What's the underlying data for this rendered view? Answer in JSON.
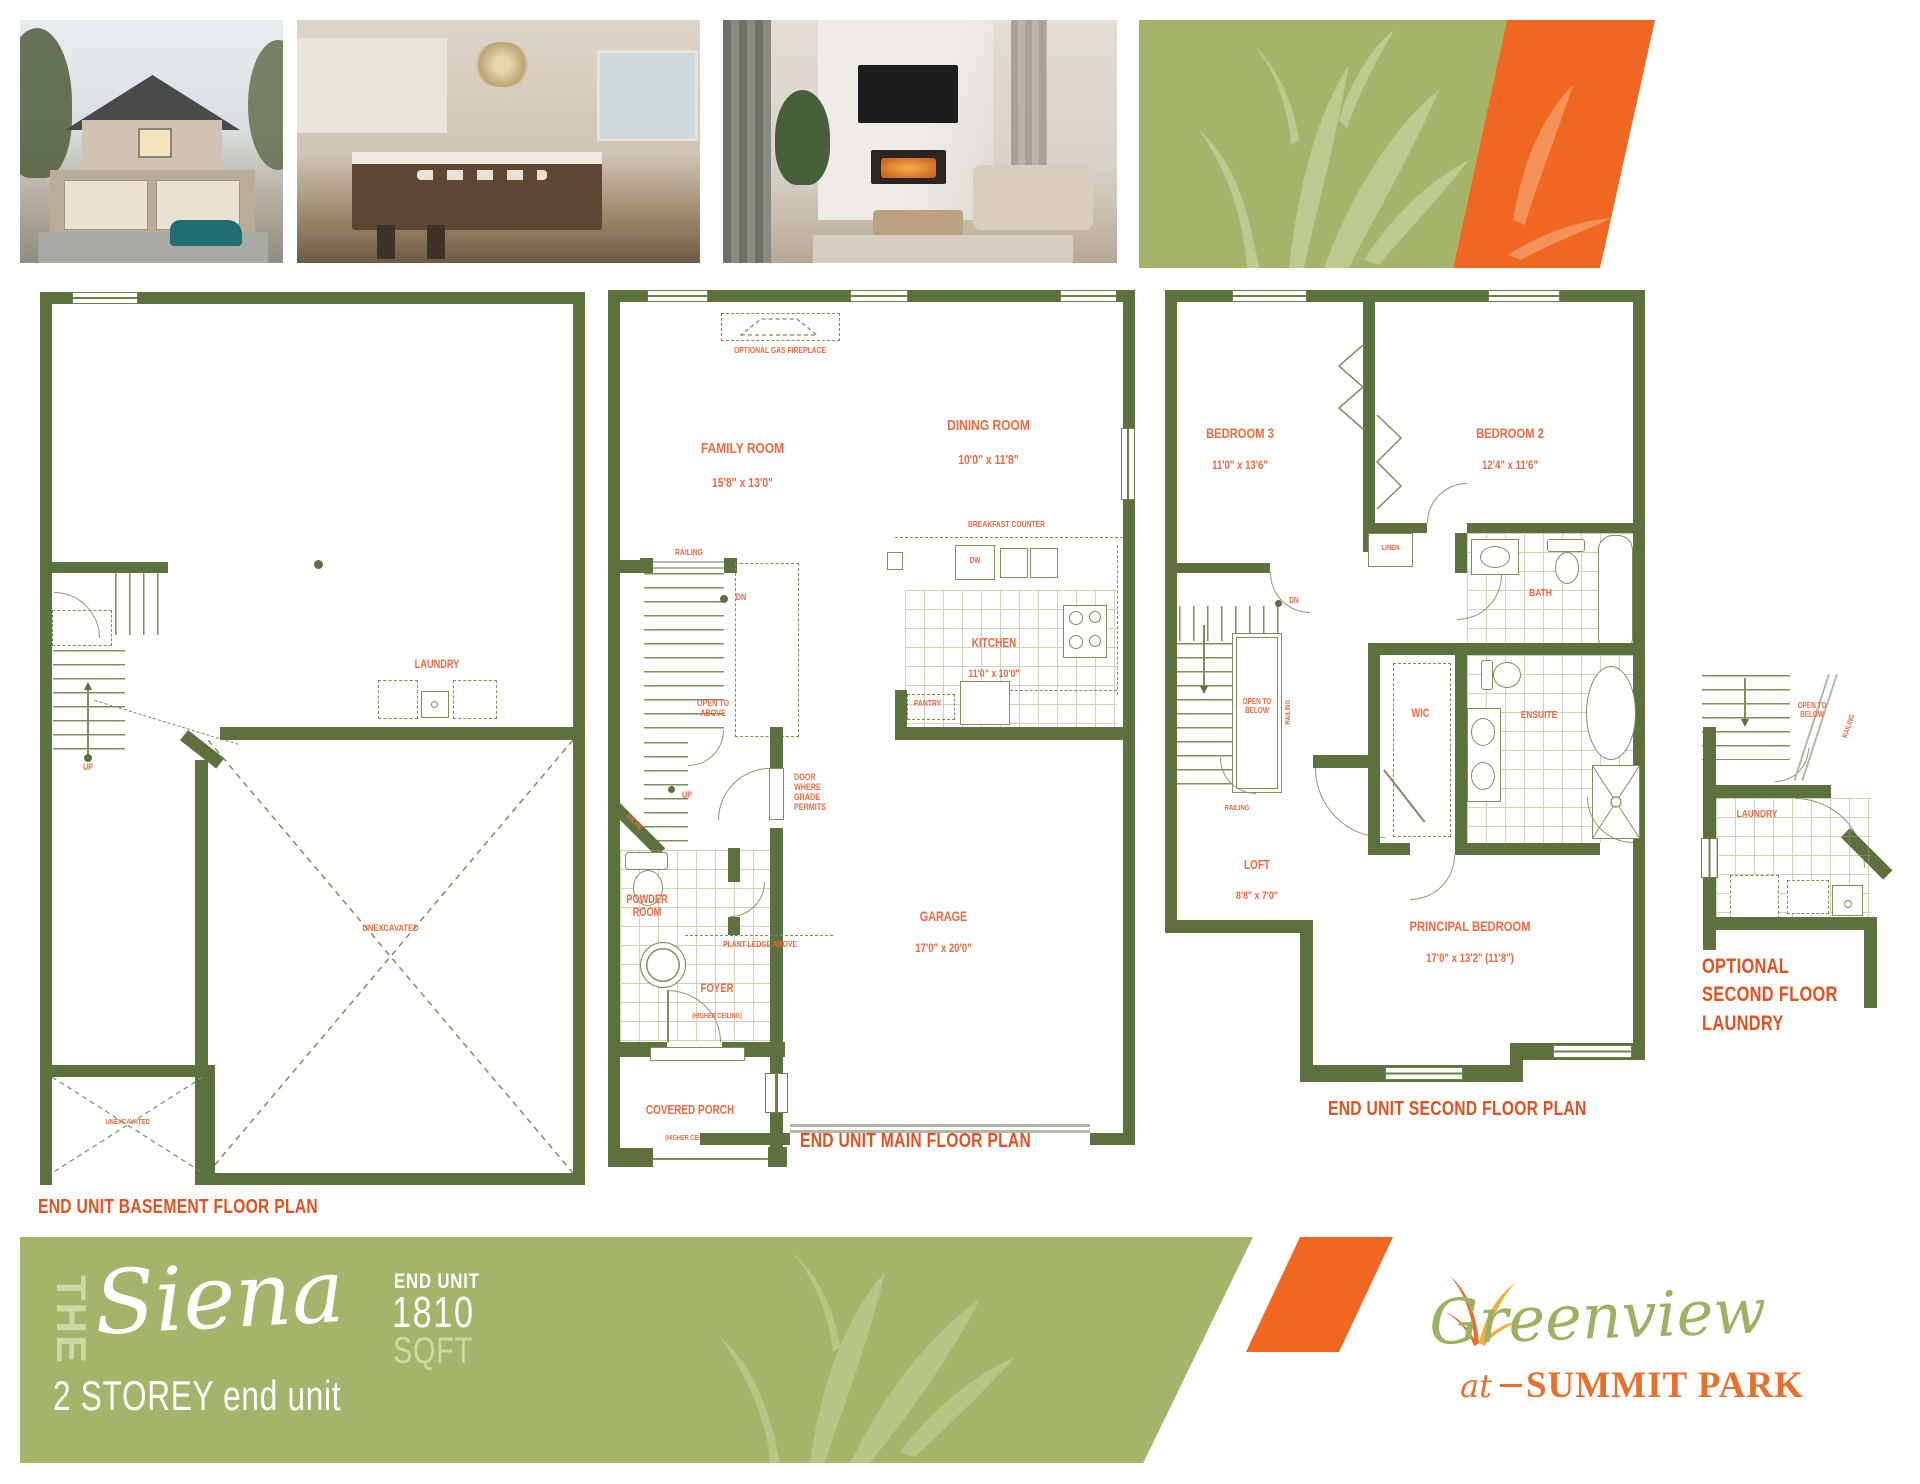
{
  "photos": [
    {
      "name": "exterior-photo"
    },
    {
      "name": "kitchen-photo"
    },
    {
      "name": "living-room-photo"
    }
  ],
  "plans": {
    "basement": {
      "caption": "END UNIT BASEMENT FLOOR PLAN",
      "labels": {
        "up": "UP",
        "laundry": "LAUNDRY",
        "unexcavated_main": "UNEXCAVATED",
        "unexcavated_small": "UNEXCAVATED"
      }
    },
    "main": {
      "caption": "END UNIT MAIN FLOOR PLAN",
      "labels": {
        "optional_gas_fireplace": "OPTIONAL GAS FIREPLACE",
        "family_room": "FAMILY ROOM",
        "family_room_dims": "15'8\" x 13'0\"",
        "dining_room": "DINING ROOM",
        "dining_room_dims": "10'0\" x 11'8\"",
        "breakfast_counter": "BREAKFAST COUNTER",
        "dw": "DW",
        "kitchen": "KITCHEN",
        "kitchen_dims": "11'0\" x 10'0\"",
        "pantry": "PANTRY",
        "railing": "RAILING",
        "dn": "DN",
        "up": "UP",
        "niche": "NICHE",
        "open_to_above": "OPEN TO\nABOVE",
        "door_where_grade_permits": "DOOR\nWHERE\nGRADE\nPERMITS",
        "powder_room": "POWDER\nROOM",
        "plant_ledge_above": "PLANT LEDGE ABOVE",
        "foyer": "FOYER",
        "foyer_note": "(HIGHER CEILING)",
        "garage": "GARAGE",
        "garage_dims": "17'0\" x 20'0\"",
        "covered_porch": "COVERED PORCH",
        "covered_porch_note": "(HIGHER CEILING)"
      }
    },
    "second": {
      "caption": "END UNIT SECOND FLOOR PLAN",
      "labels": {
        "bedroom3": "BEDROOM 3",
        "bedroom3_dims": "11'0\" x 13'6\"",
        "bedroom2": "BEDROOM 2",
        "bedroom2_dims": "12'4\" x 11'6\"",
        "linen": "LINEN",
        "bath": "BATH",
        "dn": "DN",
        "open_to_below": "OPEN TO\nBELOW",
        "railing_stair": "RAILING",
        "railing_loft": "RAILING",
        "wic": "WIC",
        "ensuite": "ENSUITE",
        "loft": "LOFT",
        "loft_dims": "8'8\" x 7'0\"",
        "principal_bedroom": "PRINCIPAL BEDROOM",
        "principal_bedroom_dims": "17'0\" x 13'2\" (11'8\")"
      }
    },
    "optional_laundry": {
      "caption": "OPTIONAL\nSECOND FLOOR\nLAUNDRY",
      "labels": {
        "open_to_below": "OPEN TO\nBELOW",
        "railing": "RAILING",
        "laundry": "LAUNDRY"
      }
    }
  },
  "footer": {
    "the": "THE",
    "model_name": "Siena",
    "storey": "2 STOREY end unit",
    "end_unit": "END UNIT",
    "sqft_value": "1810",
    "sqft_label": "SQFT"
  },
  "logo": {
    "greenview": "Greenview",
    "at": "at",
    "summit_park": "SUMMIT PARK"
  },
  "colors": {
    "wall": "#5d713e",
    "label_orange": "#ea6a42",
    "caption_orange": "#e2511f",
    "banner_green": "#a4b56b",
    "banner_orange": "#f06722",
    "light_green": "#cdd9a5",
    "logo_green": "#9db162",
    "logo_orange": "#e8702d"
  }
}
